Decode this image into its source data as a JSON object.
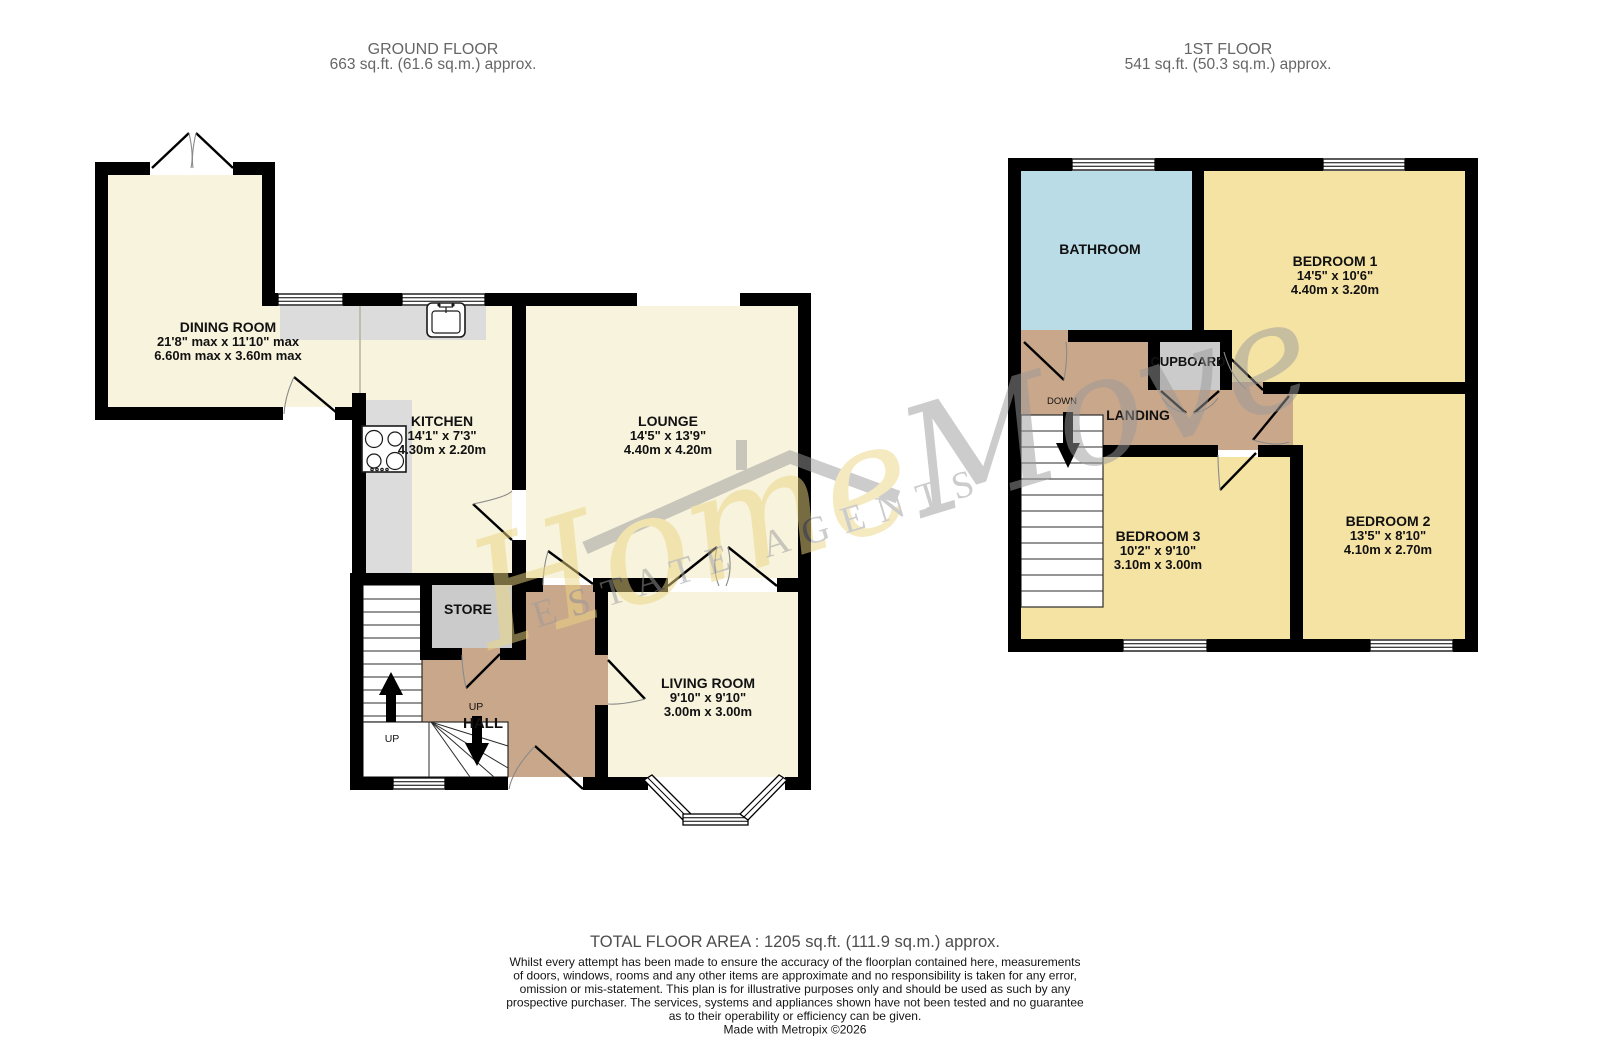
{
  "ground_floor": {
    "title": "GROUND FLOOR",
    "subtitle": "663 sq.ft. (61.6 sq.m.) approx.",
    "dining": {
      "name": "DINING ROOM",
      "imperial": "21'8\" max x 11'10\" max",
      "metric": "6.60m max x 3.60m max"
    },
    "kitchen": {
      "name": "KITCHEN",
      "imperial": "14'1\"  x 7'3\"",
      "metric": "4.30m  x 2.20m"
    },
    "lounge": {
      "name": "LOUNGE",
      "imperial": "14'5\"  x 13'9\"",
      "metric": "4.40m  x 4.20m"
    },
    "store": {
      "name": "STORE"
    },
    "hall": {
      "name": "HALL",
      "up_label_1": "UP",
      "up_label_2": "UP"
    },
    "living_room": {
      "name": "LIVING ROOM",
      "imperial": "9'10\"  x 9'10\"",
      "metric": "3.00m  x 3.00m"
    }
  },
  "first_floor": {
    "title": "1ST FLOOR",
    "subtitle": "541 sq.ft. (50.3 sq.m.) approx.",
    "bathroom": {
      "name": "BATHROOM"
    },
    "bedroom1": {
      "name": "BEDROOM 1",
      "imperial": "14'5\"  x 10'6\"",
      "metric": "4.40m  x 3.20m"
    },
    "cupboard": {
      "name": "CUPBOARD"
    },
    "landing": {
      "name": "LANDING",
      "down_label": "DOWN"
    },
    "bedroom2": {
      "name": "BEDROOM 2",
      "imperial": "13'5\"  x 8'10\"",
      "metric": "4.10m  x 2.70m"
    },
    "bedroom3": {
      "name": "BEDROOM 3",
      "imperial": "10'2\"  x 9'10\"",
      "metric": "3.10m  x 3.00m"
    }
  },
  "watermark": {
    "brand_primary": "Home",
    "brand_secondary": "Move",
    "tagline": "ESTATE AGENTS"
  },
  "footer": {
    "total": "TOTAL FLOOR AREA : 1205 sq.ft. (111.9 sq.m.) approx.",
    "disclaimer_line1": "Whilst every attempt has been made to ensure the accuracy of the floorplan contained here, measurements",
    "disclaimer_line2": "of doors, windows, rooms and any other items are approximate and no responsibility is taken for any error,",
    "disclaimer_line3": "omission or mis-statement. This plan is for illustrative purposes only and should be used as such by any",
    "disclaimer_line4": "prospective purchaser. The services, systems and appliances shown have not been tested and no guarantee",
    "disclaimer_line5": "as to their operability or efficiency can be given.",
    "credit": "Made with Metropix ©2026"
  },
  "colors": {
    "wall": "#000000",
    "room_cream": "#F7F3DD",
    "room_yellow": "#F5E3A4",
    "room_blue": "#BADCE6",
    "room_tan": "#C9A78A",
    "room_gray": "#CBCBCB",
    "counter_gray": "#DCDCDC",
    "watermark_yellow": "#EDD581",
    "watermark_gray": "#9B9B9B"
  }
}
